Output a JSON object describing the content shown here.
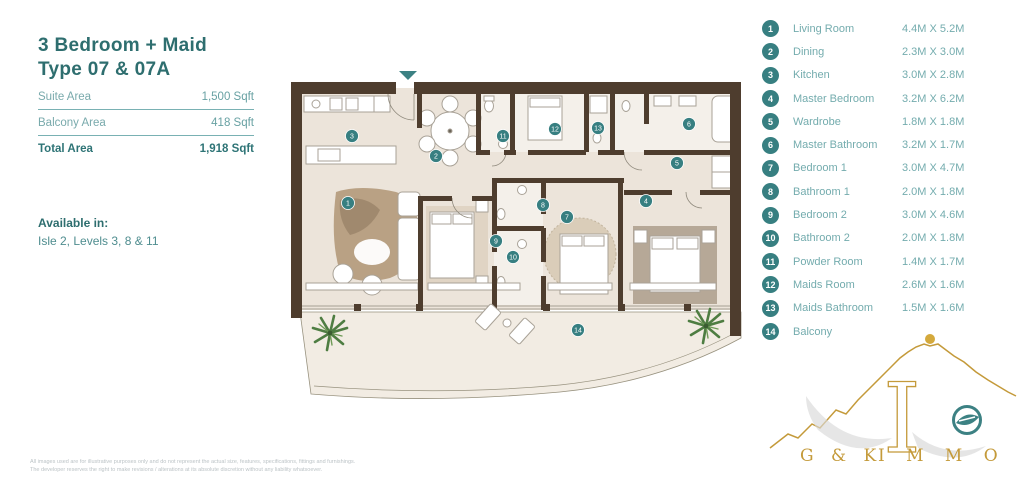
{
  "header": {
    "title_line1": "3 Bedroom + Maid",
    "title_line2": "Type 07 & 07A"
  },
  "areas": {
    "rows": [
      {
        "label": "Suite Area",
        "value": "1,500 Sqft"
      },
      {
        "label": "Balcony Area",
        "value": "418 Sqft"
      },
      {
        "label": "Total Area",
        "value": "1,918 Sqft"
      }
    ]
  },
  "availability": {
    "heading": "Available in:",
    "text": "Isle 2, Levels 3, 8 & 11"
  },
  "legend": {
    "items": [
      {
        "num": "1",
        "label": "Living Room",
        "dims": "4.4M X 5.2M"
      },
      {
        "num": "2",
        "label": "Dining",
        "dims": "2.3M X 3.0M"
      },
      {
        "num": "3",
        "label": "Kitchen",
        "dims": "3.0M X 2.8M"
      },
      {
        "num": "4",
        "label": "Master Bedroom",
        "dims": "3.2M X 6.2M"
      },
      {
        "num": "5",
        "label": "Wardrobe",
        "dims": "1.8M X 1.8M"
      },
      {
        "num": "6",
        "label": "Master Bathroom",
        "dims": "3.2M X 1.7M"
      },
      {
        "num": "7",
        "label": "Bedroom 1",
        "dims": "3.0M X 4.7M"
      },
      {
        "num": "8",
        "label": "Bathroom 1",
        "dims": "2.0M X 1.8M"
      },
      {
        "num": "9",
        "label": "Bedroom 2",
        "dims": "3.0M X 4.6M"
      },
      {
        "num": "10",
        "label": "Bathroom 2",
        "dims": "2.0M X 1.8M"
      },
      {
        "num": "11",
        "label": "Powder Room",
        "dims": "1.4M X 1.7M"
      },
      {
        "num": "12",
        "label": "Maids Room",
        "dims": "2.6M X 1.6M"
      },
      {
        "num": "13",
        "label": "Maids Bathroom",
        "dims": "1.5M X 1.6M"
      },
      {
        "num": "14",
        "label": "Balcony",
        "dims": ""
      }
    ]
  },
  "plan": {
    "markers": [
      {
        "n": "1",
        "x": 348,
        "y": 203
      },
      {
        "n": "2",
        "x": 436,
        "y": 156
      },
      {
        "n": "3",
        "x": 352,
        "y": 136
      },
      {
        "n": "4",
        "x": 646,
        "y": 201
      },
      {
        "n": "5",
        "x": 677,
        "y": 163
      },
      {
        "n": "6",
        "x": 689,
        "y": 124
      },
      {
        "n": "7",
        "x": 567,
        "y": 217
      },
      {
        "n": "8",
        "x": 543,
        "y": 205
      },
      {
        "n": "9",
        "x": 496,
        "y": 241
      },
      {
        "n": "10",
        "x": 513,
        "y": 257
      },
      {
        "n": "11",
        "x": 503,
        "y": 136
      },
      {
        "n": "12",
        "x": 555,
        "y": 129
      },
      {
        "n": "13",
        "x": 598,
        "y": 128
      },
      {
        "n": "14",
        "x": 578,
        "y": 330
      }
    ]
  },
  "logo": {
    "brand_left": "G & K",
    "brand_right": "I M M O"
  },
  "footer": {
    "line1": "All images used are for illustrative purposes only and do not represent the actual size, features, specifications, fittings and furnishings.",
    "line2": "The developer reserves the right to make revisions / alterations at its absolute discretion without any liability whatsoever."
  },
  "colors": {
    "accent_teal": "#2e6e6f",
    "marker_teal": "#377f81",
    "wall_brown": "#4e3d2e",
    "floor_beige": "#ece4da",
    "logo_gold": "#c49a3a"
  }
}
